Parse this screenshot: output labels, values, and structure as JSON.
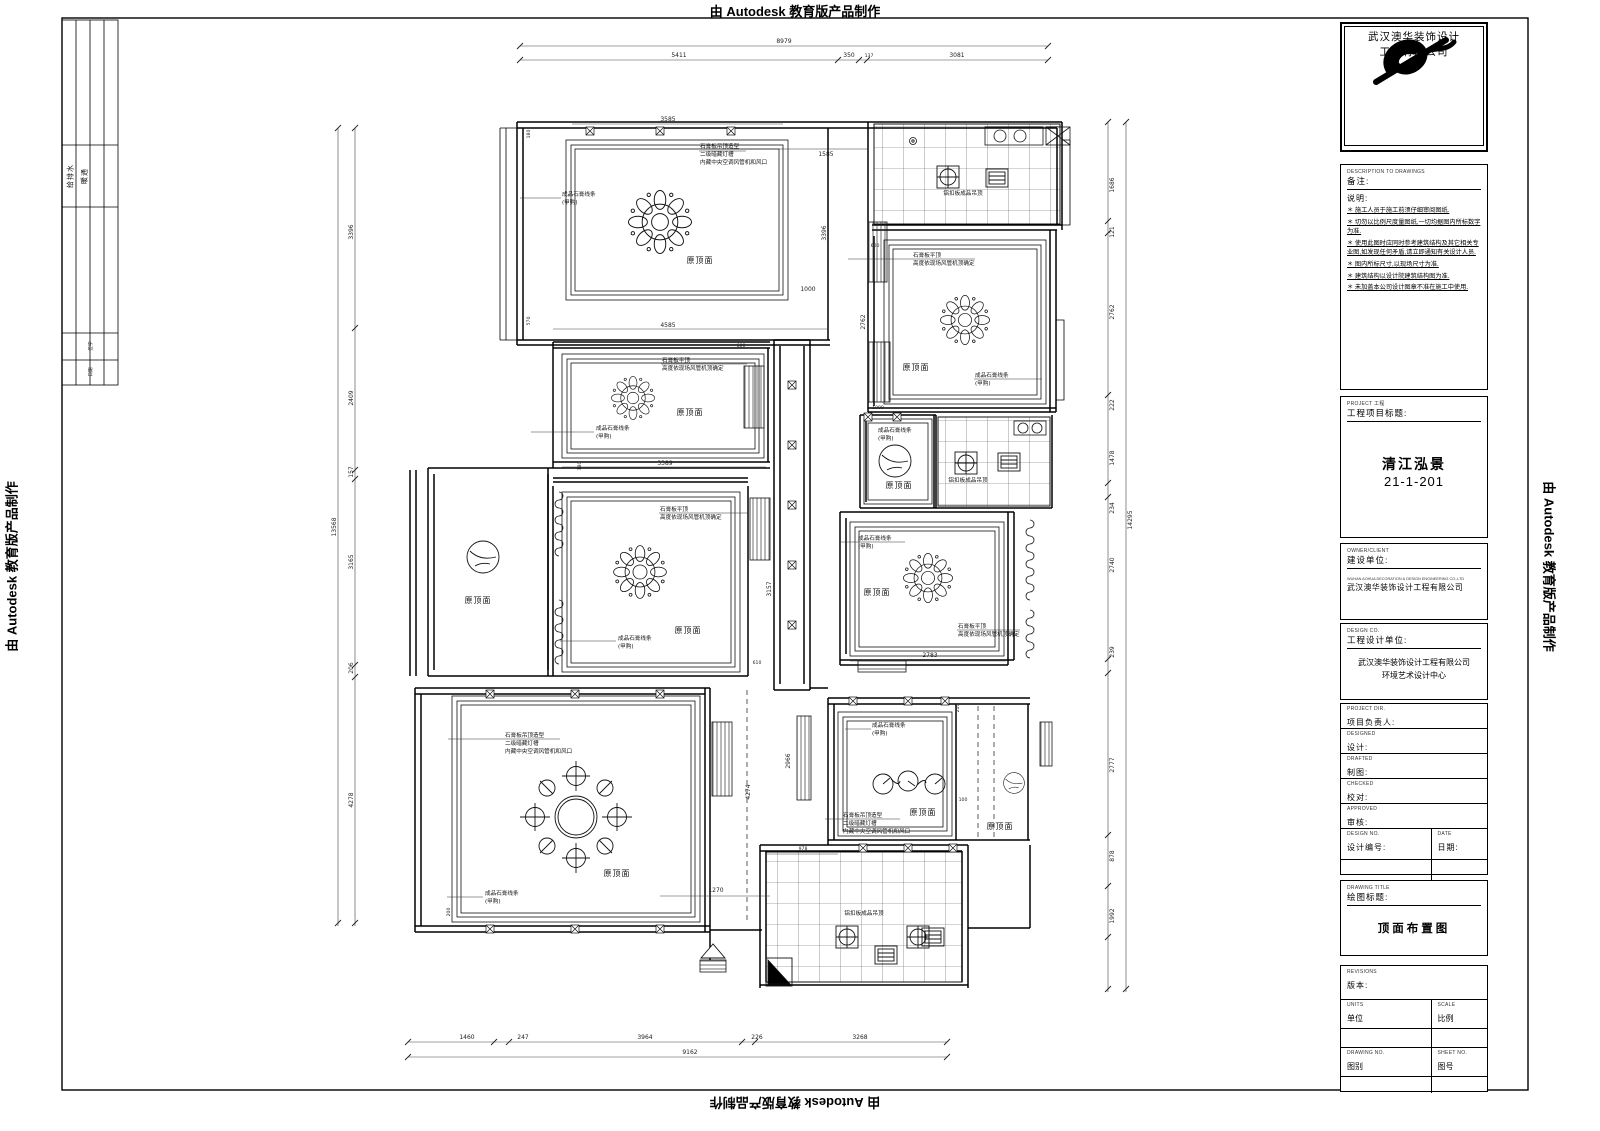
{
  "frame": {
    "banner": "由 Autodesk 教育版产品制作",
    "signbar": {
      "col1": "给排水",
      "col2": "暖通",
      "row1": "签字",
      "row2": "日期"
    }
  },
  "titleblock": {
    "company_cn1": "武汉澳华装饰设计",
    "company_cn2": "工程有限公司",
    "remarks": {
      "en": "DESCRIPTION TO DRAWINGS",
      "title": "备注:",
      "subtitle": "说明:",
      "notes": [
        "＊ 施工人员于施工前须仔细审阅图纸.",
        "＊ 切勿以比例尺度量图纸,一切均据图内所标数字为准.",
        "＊ 使用此图时应同时参考建筑结构及其它相关专业图,如发现任何矛盾,请立即通知有关设计人员.",
        "＊ 图内所标尺寸,以现场尺寸为准.",
        "＊ 建筑结构以设计院建筑结构图为准.",
        "＊ 未加盖本公司设计图章不准在施工中使用."
      ]
    },
    "project": {
      "en": "PROJECT 工程",
      "label": "工程项目标题:",
      "name": "清江泓景",
      "no": "21-1-201"
    },
    "owner": {
      "en": "OWNER/CLIENT",
      "label": "建设单位:",
      "value_en": "WUHAN AOHUA DECORATION & DESIGN ENGINEERING CO.,LTD",
      "value": "武汉澳华装饰设计工程有限公司"
    },
    "designer": {
      "en": "DESIGN CO.",
      "label": "工程设计单位:",
      "value1": "武汉澳华装饰设计工程有限公司",
      "value2": "环境艺术设计中心"
    },
    "fields": [
      {
        "en": "PROJECT DIR.",
        "label": "项目负责人:"
      },
      {
        "en": "DESIGNED",
        "label": "设计:"
      },
      {
        "en": "DRAFTED",
        "label": "制图:"
      },
      {
        "en": "CHECKED",
        "label": "校对:"
      },
      {
        "en": "APPROVED",
        "label": "审核:"
      }
    ],
    "design_no": {
      "en": "DESIGN NO.",
      "label": "设计编号:"
    },
    "date": {
      "en": "DATE",
      "label": "日期:"
    },
    "drawing_title": {
      "en": "DRAWING TITLE",
      "label": "绘图标题:",
      "value": "顶面布置图"
    },
    "version": {
      "en": "REVISIONS",
      "label": "版本:"
    },
    "units": {
      "en": "UNITS",
      "label": "单位"
    },
    "scale": {
      "en": "SCALE",
      "label": "比例"
    },
    "cat": {
      "en": "DRAWING NO.",
      "label": "图别"
    },
    "sheet": {
      "en": "SHEET NO.",
      "label": "图号"
    }
  },
  "plan": {
    "labels": {
      "orig": "原顶面",
      "alum": "铝扣板成品吊顶"
    },
    "ann": {
      "shape1": "石膏板吊顶造型",
      "shape2": "二级暗藏灯槽",
      "shape3": "内藏中央空调风管机和风口",
      "flat1": "石膏板平顶",
      "flat2": "高度依现场风管机顶确定",
      "mold1": "成品石膏线条",
      "mold2": "(甲购)"
    },
    "dims": {
      "top_total": "8979",
      "top": [
        "5411",
        "350",
        "137",
        "3081"
      ],
      "bottom": [
        "1460",
        "247",
        "3964",
        "226",
        "3268"
      ],
      "bottom_total": "9162",
      "left": [
        "3396",
        "2409",
        "157",
        "3165",
        "206",
        "4278"
      ],
      "left_total": "13568",
      "right": [
        "1686",
        "121",
        "2762",
        "222",
        "1478",
        "234",
        "2740",
        "239",
        "2777",
        "878",
        "1992"
      ],
      "right_total": "14295",
      "inner": [
        "3585",
        "180",
        "570",
        "4585",
        "1585",
        "3396",
        "1000",
        "600",
        "3389",
        "180",
        "600",
        "2762",
        "1000",
        "3157",
        "610",
        "2783",
        "100",
        "210",
        "2966",
        "4274",
        "978",
        "1270",
        "200"
      ]
    }
  }
}
